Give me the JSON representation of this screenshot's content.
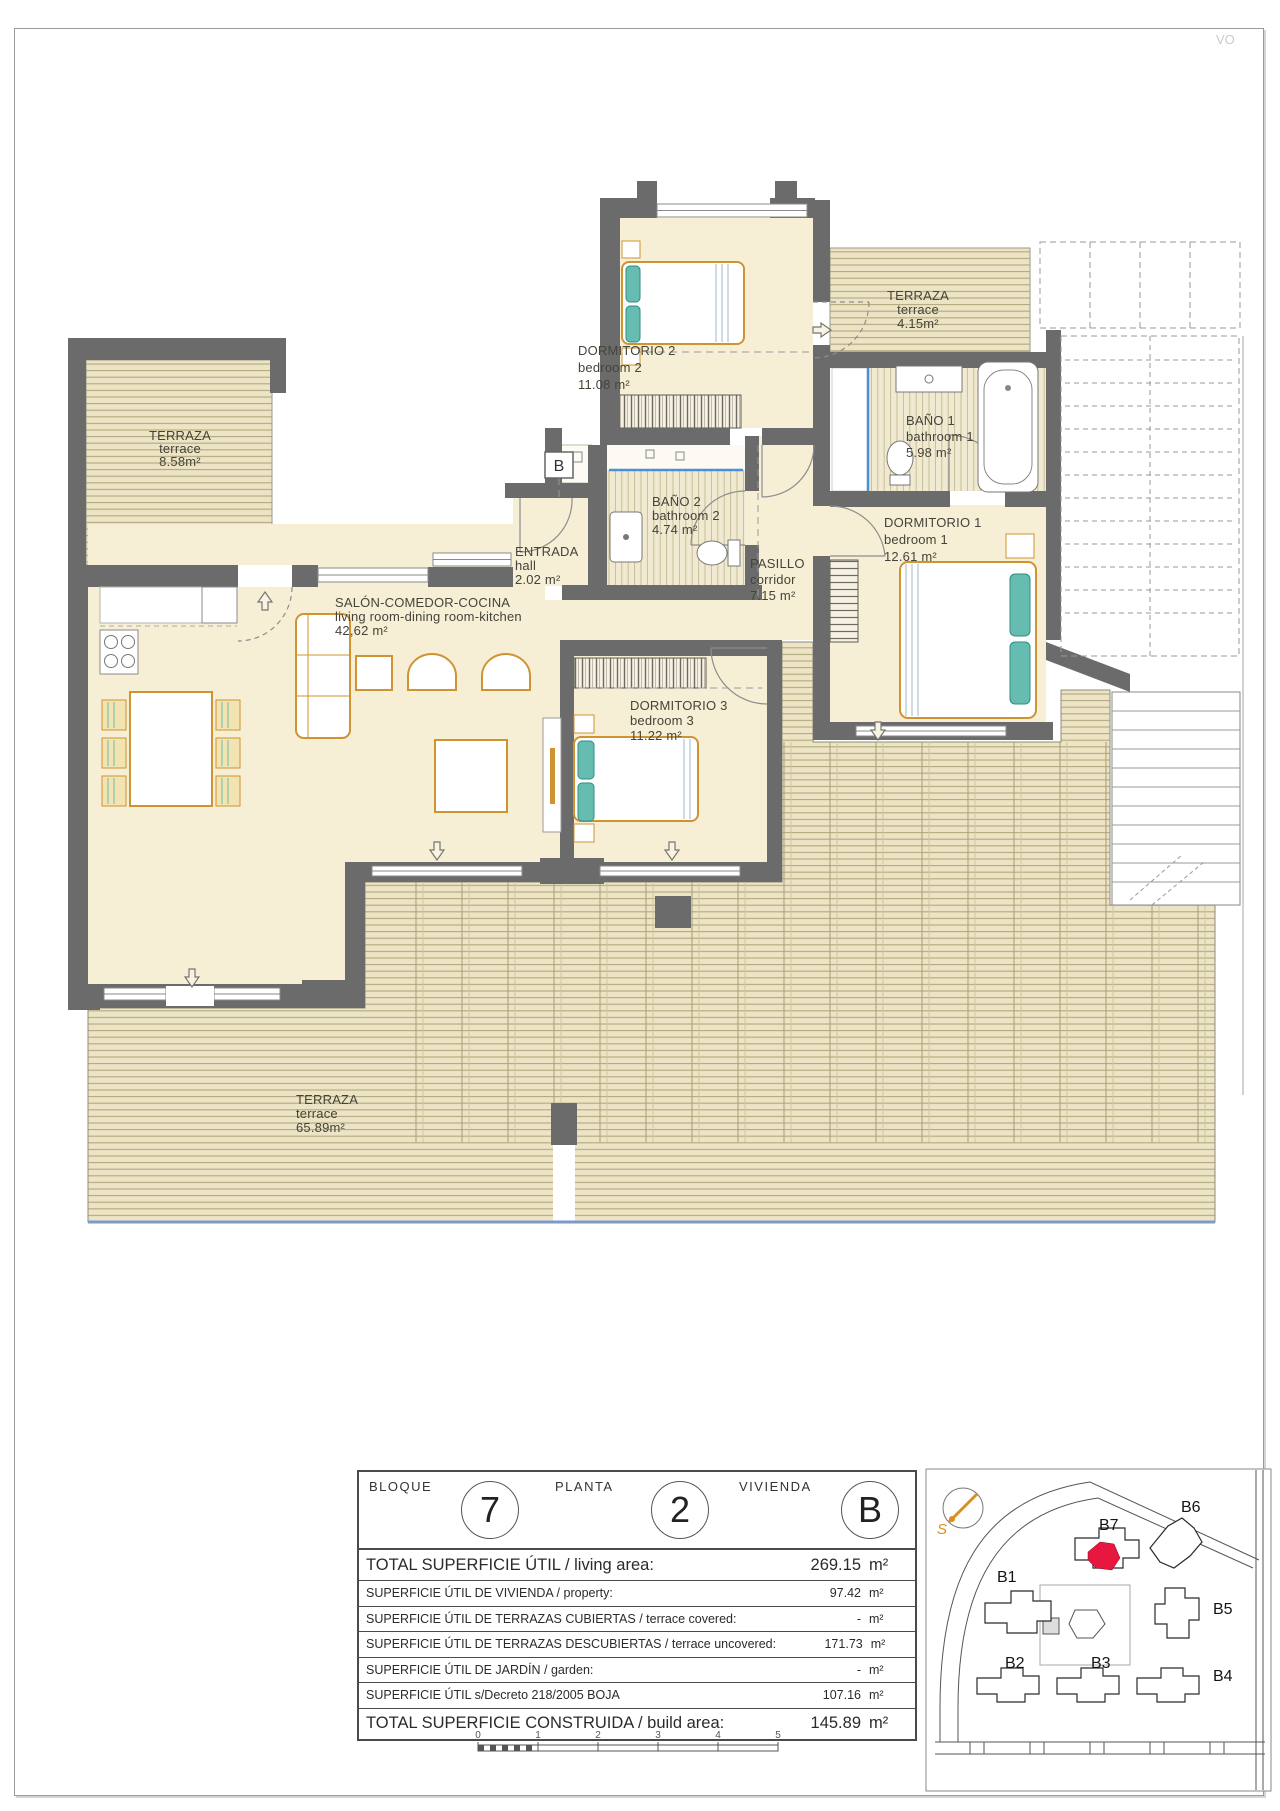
{
  "page": {
    "watermark": "VO",
    "section_marker": "B"
  },
  "rooms": [
    {
      "name_es": "DORMITORIO 2",
      "name_en": "bedroom 2",
      "area": "11.08 m²"
    },
    {
      "name_es": "TERRAZA",
      "name_en": "terrace",
      "area": "4.15m²"
    },
    {
      "name_es": "BAÑO 1",
      "name_en": "bathroom 1",
      "area": "5.98 m²"
    },
    {
      "name_es": "DORMITORIO 1",
      "name_en": "bedroom 1",
      "area": "12.61 m²"
    },
    {
      "name_es": "PASILLO",
      "name_en": "corridor",
      "area": "7.15 m²"
    },
    {
      "name_es": "BAÑO 2",
      "name_en": "bathroom 2",
      "area": "4.74 m²"
    },
    {
      "name_es": "ENTRADA",
      "name_en": "hall",
      "area": "2.02 m²"
    },
    {
      "name_es": "SALÓN-COMEDOR-COCINA",
      "name_en": "living room-dining room-kitchen",
      "area": "42,62 m²"
    },
    {
      "name_es": "DORMITORIO 3",
      "name_en": "bedroom 3",
      "area": "11.22 m²"
    },
    {
      "name_es": "TERRAZA",
      "name_en": "terrace",
      "area": "8.58m²"
    },
    {
      "name_es": "TERRAZA",
      "name_en": "terrace",
      "area": "65.89m²"
    }
  ],
  "summary": {
    "header": [
      {
        "label": "BLOQUE",
        "value": "7"
      },
      {
        "label": "PLANTA",
        "value": "2"
      },
      {
        "label": "VIVIENDA",
        "value": "B"
      }
    ],
    "rows": [
      {
        "label": "TOTAL SUPERFICIE ÚTIL / living area:",
        "value": "269.15",
        "unit": "m²"
      },
      {
        "label": "SUPERFICIE ÚTIL DE VIVIENDA / property:",
        "value": "97.42",
        "unit": "m²"
      },
      {
        "label": "SUPERFICIE ÚTIL DE TERRAZAS CUBIERTAS / terrace covered:",
        "value": "-",
        "unit": "m²"
      },
      {
        "label": "SUPERFICIE ÚTIL DE TERRAZAS DESCUBIERTAS / terrace uncovered:",
        "value": "171.73",
        "unit": "m²"
      },
      {
        "label": "SUPERFICIE ÚTIL DE JARDÍN / garden:",
        "value": "-",
        "unit": "m²"
      },
      {
        "label": "SUPERFICIE ÚTIL s/Decreto 218/2005 BOJA",
        "value": "107.16",
        "unit": "m²"
      },
      {
        "label": "TOTAL SUPERFICIE CONSTRUIDA / build area:",
        "value": "145.89",
        "unit": "m²"
      }
    ]
  },
  "scale_bar": {
    "ticks": [
      "0",
      "1",
      "2",
      "3",
      "4",
      "5"
    ]
  },
  "site_plan": {
    "compass_label": "S",
    "highlight_color": "#e8173f",
    "buildings": [
      {
        "label": "B1"
      },
      {
        "label": "B2"
      },
      {
        "label": "B3"
      },
      {
        "label": "B4"
      },
      {
        "label": "B5"
      },
      {
        "label": "B6"
      },
      {
        "label": "B7"
      }
    ]
  }
}
